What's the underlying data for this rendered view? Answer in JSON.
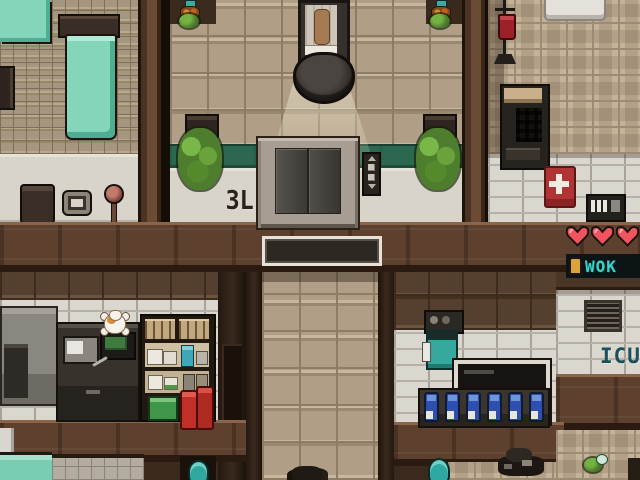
{
  "scene": {
    "description": "Top-down pixel-art hospital floor with elevator lobby, operating room, ward, lab and ICU",
    "signs": {
      "floor_sign": "3L",
      "icu_sign": "ICU"
    },
    "hud": {
      "hearts": {
        "count": 3,
        "fill": "#f2545e",
        "outline": "#1c1210",
        "highlight": "#ffb3b6"
      },
      "ticker": {
        "icon": "lamp-icon",
        "text": "WOK",
        "color": "#3bd3cb"
      }
    },
    "palette": {
      "corridor_tile": "#b09f86",
      "wall_top_brown": "#5d402d",
      "wall_white": "#d8d4ca",
      "accent_green_stripe": "#2c6750",
      "bed_teal": "#84d6ba",
      "alert_red": "#b13434",
      "bottle_blue": "#2f4fae",
      "barrel_teal": "#2fa8a0"
    },
    "rooms": {
      "ward": {
        "objects": [
          "bed",
          "bed",
          "wall-fixture",
          "coffee-box",
          "plate",
          "round-stand"
        ]
      },
      "operating_room": {
        "objects": [
          "operating-table",
          "patient",
          "surgical-lamp",
          "light-cone",
          "wall-planter",
          "wall-planter",
          "potted-plant",
          "potted-plant"
        ]
      },
      "elevator_lobby": {
        "objects": [
          "elevator-doors",
          "elevator-call-panel",
          "floor-sign",
          "doormat"
        ]
      },
      "medical_room": {
        "objects": [
          "iv-stand",
          "blood-bag",
          "gurney",
          "monitor-cabinet",
          "first-aid-kit",
          "intercom"
        ]
      },
      "lab": {
        "objects": [
          "grey-cabinet",
          "lab-device",
          "lab-counter",
          "microwave",
          "green-monitor",
          "cat",
          "supply-shelf",
          "teal-bottle",
          "green-crate",
          "red-canisters"
        ]
      },
      "icu": {
        "bottle_count": 6,
        "objects": [
          "camera-device",
          "teal-machine",
          "display-case",
          "bottle-counter",
          "vent-grate"
        ]
      },
      "lower_rooms": {
        "objects": [
          "teal-barrel",
          "teal-barrel",
          "junk-pile",
          "small-plant",
          "dark-plant"
        ]
      }
    }
  }
}
